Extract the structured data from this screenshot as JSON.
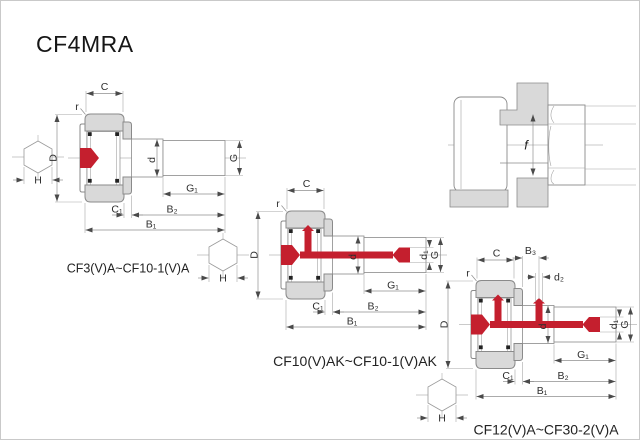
{
  "title": "CF4MRA",
  "colors": {
    "red": "#c41f2e",
    "gray_fill": "#d9d9d9",
    "line": "#8a8a8a"
  },
  "figures": {
    "fig1": {
      "caption": "CF3(V)A~CF10-1(V)A",
      "labels": {
        "C": "C",
        "r": "r",
        "D": "D",
        "d": "d",
        "G": "G",
        "G1": "G₁",
        "C1": "C₁",
        "B2": "B₂",
        "B1": "B₁",
        "H": "H"
      }
    },
    "fig2": {
      "caption": "CF10(V)AK~CF10-1(V)AK",
      "labels": {
        "C": "C",
        "r": "r",
        "D": "D",
        "d": "d",
        "d1": "d₁",
        "G": "G",
        "G1": "G₁",
        "C1": "C₁",
        "B2": "B₂",
        "B1": "B₁",
        "H": "H"
      }
    },
    "fig3": {
      "caption": "CF12(V)A~CF30-2(V)A",
      "labels": {
        "C": "C",
        "B3": "B₃",
        "d2": "d₂",
        "r": "r",
        "D": "D",
        "d": "d",
        "d1": "d₁",
        "G": "G",
        "G1": "G₁",
        "C1": "C₁",
        "B2": "B₂",
        "B1": "B₁",
        "H": "H"
      }
    },
    "detail": {
      "labels": {
        "f": "f"
      }
    }
  }
}
